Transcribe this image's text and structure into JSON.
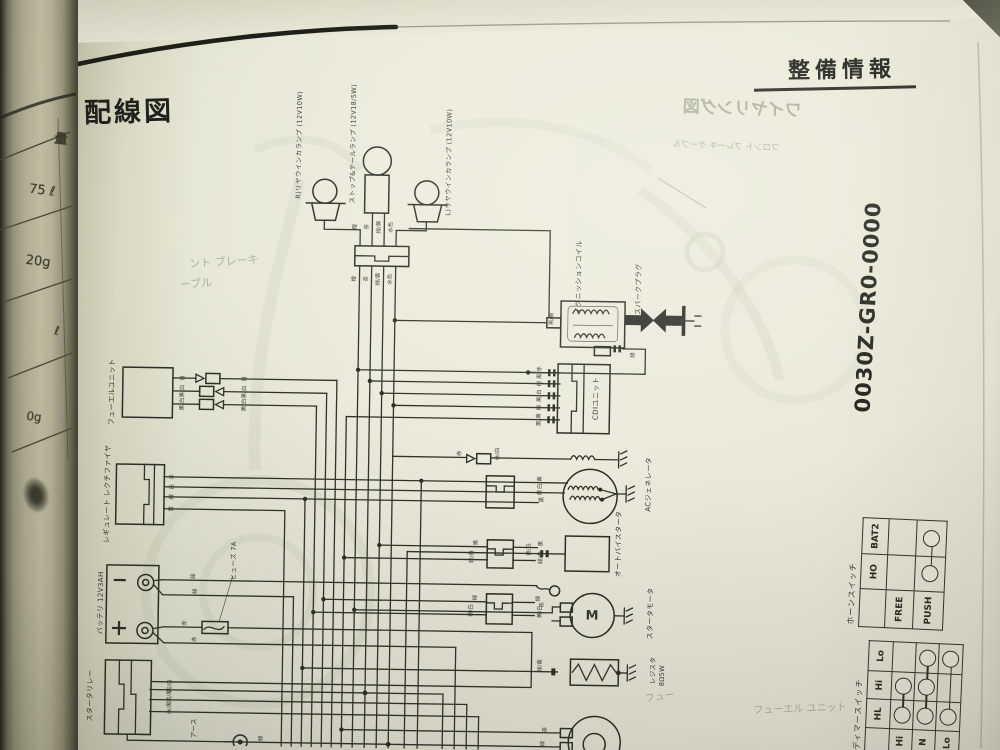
{
  "page": {
    "section_title": "整備情報",
    "title": "配線図",
    "part_number": "0030Z-GR0-0000"
  },
  "horn_switch": {
    "title": "ホーンスイッチ",
    "col_headers": [
      "HO",
      "BAT2"
    ],
    "rows": [
      {
        "label": "FREE",
        "connected": []
      },
      {
        "label": "PUSH",
        "connected": [
          "HO",
          "BAT2"
        ]
      }
    ]
  },
  "dimmer_switch": {
    "title": "ディマースイッチ",
    "col_headers": [
      "HL",
      "Hi",
      "Lo"
    ],
    "rows": [
      {
        "label": "Hi",
        "connected": [
          "HL",
          "Hi"
        ]
      },
      {
        "label": "N",
        "connected": [
          "HL",
          "Hi",
          "Lo"
        ]
      },
      {
        "label": "Lo",
        "connected": [
          "HL",
          "Lo"
        ]
      }
    ]
  },
  "render": {
    "labels": [
      {
        "k": "comp",
        "t": "R)リヤウインカランプ (12V10W)",
        "x": 296,
        "y": 148,
        "fs": 6.5,
        "r": -90
      },
      {
        "k": "comp",
        "t": "ストップ&テールランプ (12V18/5W)",
        "x": 350,
        "y": 146,
        "fs": 6.5,
        "r": -90
      },
      {
        "k": "comp",
        "t": "L)リヤウインカランプ (12V10W)",
        "x": 446,
        "y": 163,
        "fs": 6.5,
        "r": -90
      },
      {
        "k": "comp",
        "t": "イグニッションコイル",
        "x": 578,
        "y": 276,
        "fs": 7,
        "r": -90
      },
      {
        "k": "comp",
        "t": "スパークプラグ",
        "x": 638,
        "y": 287,
        "fs": 7,
        "r": -90
      },
      {
        "k": "comp",
        "t": "CDIユニット",
        "x": 597,
        "y": 397,
        "fs": 7,
        "r": -90
      },
      {
        "k": "comp",
        "t": "ACジェネレータ",
        "x": 651,
        "y": 482,
        "fs": 7,
        "r": -90
      },
      {
        "k": "comp",
        "t": "オートバイスタータ",
        "x": 622,
        "y": 542,
        "fs": 7,
        "r": -90
      },
      {
        "k": "comp",
        "t": "スタータモータ",
        "x": 655,
        "y": 611,
        "fs": 7,
        "r": -90
      },
      {
        "k": "comp",
        "t": "レジスタ",
        "x": 658,
        "y": 668,
        "fs": 6.5,
        "r": -90
      },
      {
        "k": "comp",
        "t": "8Ω5W",
        "x": 667,
        "y": 673,
        "fs": 6.5,
        "r": -90
      },
      {
        "k": "comp",
        "t": "フューエルユニット",
        "x": 113,
        "y": 398,
        "fs": 7,
        "r": -90
      },
      {
        "k": "comp",
        "t": "レギュレート レクチファイヤ",
        "x": 110,
        "y": 500,
        "fs": 7,
        "r": -90
      },
      {
        "k": "comp",
        "t": "ヒューズ 7A",
        "x": 237,
        "y": 565,
        "fs": 6.5,
        "r": -90
      },
      {
        "k": "comp",
        "t": "バッテリ 12V3AH",
        "x": 105,
        "y": 609,
        "fs": 7,
        "r": -90
      },
      {
        "k": "comp",
        "t": "スタータリレー",
        "x": 96,
        "y": 702,
        "fs": 7,
        "r": -90
      },
      {
        "k": "comp",
        "t": "アース",
        "x": 200,
        "y": 733,
        "fs": 6.5,
        "r": -90
      },
      {
        "k": "comp",
        "t": "M",
        "x": 596,
        "y": 615,
        "fs": 13,
        "r": 0,
        "b": 1
      },
      {
        "k": "wire",
        "t": "橙",
        "x": 354,
        "y": 229,
        "fs": 5.5,
        "r": -90
      },
      {
        "k": "wire",
        "t": "茶",
        "x": 366,
        "y": 229,
        "fs": 5.5,
        "r": -90
      },
      {
        "k": "wire",
        "t": "緑/黄",
        "x": 378,
        "y": 229,
        "fs": 5.5,
        "r": -90
      },
      {
        "k": "wire",
        "t": "水色",
        "x": 390,
        "y": 229,
        "fs": 5.5,
        "r": -90
      },
      {
        "k": "wire",
        "t": "橙",
        "x": 354,
        "y": 281,
        "fs": 5.5,
        "r": -90
      },
      {
        "k": "wire",
        "t": "茶",
        "x": 366,
        "y": 281,
        "fs": 5.5,
        "r": -90
      },
      {
        "k": "wire",
        "t": "緑/黄",
        "x": 378,
        "y": 281,
        "fs": 5.5,
        "r": -90
      },
      {
        "k": "wire",
        "t": "水色",
        "x": 390,
        "y": 281,
        "fs": 5.5,
        "r": -90
      },
      {
        "k": "wire",
        "t": "青",
        "x": 184,
        "y": 383,
        "fs": 5.5,
        "r": -90
      },
      {
        "k": "wire",
        "t": "青",
        "x": 246,
        "y": 383,
        "fs": 5.5,
        "r": -90
      },
      {
        "k": "wire",
        "t": "黒/白",
        "x": 184,
        "y": 396,
        "fs": 5.5,
        "r": -90
      },
      {
        "k": "wire",
        "t": "黒/白",
        "x": 246,
        "y": 396,
        "fs": 5.5,
        "r": -90
      },
      {
        "k": "wire",
        "t": "黒/白",
        "x": 184,
        "y": 409,
        "fs": 5.5,
        "r": -90
      },
      {
        "k": "wire",
        "t": "黒/白",
        "x": 246,
        "y": 409,
        "fs": 5.5,
        "r": -90
      },
      {
        "k": "wire",
        "t": "赤",
        "x": 175,
        "y": 482,
        "fs": 5.5,
        "r": -90
      },
      {
        "k": "wire",
        "t": "白",
        "x": 175,
        "y": 492,
        "fs": 5.5,
        "r": -90
      },
      {
        "k": "wire",
        "t": "緑",
        "x": 175,
        "y": 502,
        "fs": 5.5,
        "r": -90
      },
      {
        "k": "wire",
        "t": "黄",
        "x": 175,
        "y": 514,
        "fs": 5.5,
        "r": -90
      },
      {
        "k": "wire",
        "t": "緑",
        "x": 198,
        "y": 581,
        "fs": 5.5,
        "r": -90
      },
      {
        "k": "wire",
        "t": "緑",
        "x": 200,
        "y": 596,
        "fs": 5.5,
        "r": -90
      },
      {
        "k": "wire",
        "t": "赤",
        "x": 190,
        "y": 628,
        "fs": 5.5,
        "r": -90
      },
      {
        "k": "wire",
        "t": "赤",
        "x": 200,
        "y": 644,
        "fs": 5.5,
        "r": -90
      },
      {
        "k": "wire",
        "t": "黒/白",
        "x": 176,
        "y": 691,
        "fs": 5.5,
        "r": -90
      },
      {
        "k": "wire",
        "t": "黄/黒",
        "x": 176,
        "y": 701,
        "fs": 5.5,
        "r": -90
      },
      {
        "k": "wire",
        "t": "赤/黒",
        "x": 176,
        "y": 713,
        "fs": 5.5,
        "r": -90
      },
      {
        "k": "wire",
        "t": "緑",
        "x": 268,
        "y": 742,
        "fs": 5.5,
        "r": -90
      },
      {
        "k": "wire",
        "t": "黒/赤",
        "x": 541,
        "y": 372,
        "fs": 5.5,
        "r": -90
      },
      {
        "k": "wire",
        "t": "橙",
        "x": 541,
        "y": 383,
        "fs": 5.5,
        "r": -90
      },
      {
        "k": "wire",
        "t": "黒/白",
        "x": 541,
        "y": 395,
        "fs": 5.5,
        "r": -90
      },
      {
        "k": "wire",
        "t": "緑",
        "x": 541,
        "y": 407,
        "fs": 5.5,
        "r": -90
      },
      {
        "k": "wire",
        "t": "黒/黄",
        "x": 541,
        "y": 419,
        "fs": 5.5,
        "r": -90
      },
      {
        "k": "wire",
        "t": "黒/黄",
        "x": 552,
        "y": 318,
        "fs": 5.5,
        "r": -90
      },
      {
        "k": "wire",
        "t": "緑",
        "x": 634,
        "y": 353,
        "fs": 5.5,
        "r": -90
      },
      {
        "k": "wire",
        "t": "白/黄",
        "x": 543,
        "y": 482,
        "fs": 5.5,
        "r": -90
      },
      {
        "k": "wire",
        "t": "黄",
        "x": 543,
        "y": 492,
        "fs": 5.5,
        "r": -90
      },
      {
        "k": "wire",
        "t": "黄/白",
        "x": 533,
        "y": 549,
        "fs": 5.5,
        "r": -90
      },
      {
        "k": "wire",
        "t": "赤",
        "x": 547,
        "y": 604,
        "fs": 5.5,
        "r": -90
      },
      {
        "k": "wire",
        "t": "緑/黄",
        "x": 546,
        "y": 665,
        "fs": 5.5,
        "r": -90
      },
      {
        "k": "wire",
        "t": "茶",
        "x": 552,
        "y": 729,
        "fs": 5.5,
        "r": -90
      },
      {
        "k": "wire",
        "t": "緑",
        "x": 550,
        "y": 743,
        "fs": 5.5,
        "r": -90
      },
      {
        "k": "wire",
        "t": "赤",
        "x": 462,
        "y": 454,
        "fs": 5.5,
        "r": -90
      },
      {
        "k": "wire",
        "t": "赤/白",
        "x": 500,
        "y": 454,
        "fs": 5.5,
        "r": -90
      },
      {
        "k": "wire",
        "t": "黒",
        "x": 545,
        "y": 499,
        "fs": 5.5,
        "r": -90
      },
      {
        "k": "wire",
        "t": "黒",
        "x": 480,
        "y": 543,
        "fs": 5.5,
        "r": -90
      },
      {
        "k": "wire",
        "t": "黒",
        "x": 545,
        "y": 543,
        "fs": 5.5,
        "r": -90
      },
      {
        "k": "wire",
        "t": "緑/黄",
        "x": 476,
        "y": 557,
        "fs": 5.5,
        "r": -90
      },
      {
        "k": "wire",
        "t": "緑/黄",
        "x": 545,
        "y": 557,
        "fs": 5.5,
        "r": -90
      },
      {
        "k": "wire",
        "t": "緑",
        "x": 480,
        "y": 598,
        "fs": 5.5,
        "r": -90
      },
      {
        "k": "wire",
        "t": "緑",
        "x": 543,
        "y": 598,
        "fs": 5.5,
        "r": -90
      },
      {
        "k": "wire",
        "t": "黄/白",
        "x": 476,
        "y": 611,
        "fs": 5.5,
        "r": -90
      },
      {
        "k": "wire",
        "t": "黄/白",
        "x": 545,
        "y": 611,
        "fs": 5.5,
        "r": -90
      },
      {
        "k": "strip",
        "t": "量",
        "x": 61,
        "y": 140,
        "fs": 13,
        "r": 7,
        "b": 1
      },
      {
        "k": "strip",
        "t": "75 ℓ",
        "x": 42,
        "y": 191,
        "fs": 13,
        "r": 7
      },
      {
        "k": "strip",
        "t": "20g",
        "x": 38,
        "y": 262,
        "fs": 13,
        "r": 7
      },
      {
        "k": "strip",
        "t": "ℓ",
        "x": 57,
        "y": 331,
        "fs": 12,
        "r": 7
      },
      {
        "k": "strip",
        "t": "0g",
        "x": 34,
        "y": 417,
        "fs": 12,
        "r": 7
      },
      {
        "k": "ghost",
        "t": "ワイヤリング図",
        "x": 742,
        "y": 110,
        "fs": 17,
        "r": 2,
        "b": 1,
        "mx": 1
      },
      {
        "k": "ghost",
        "t": "フロント ブレーキ ケーブル",
        "x": 726,
        "y": 147,
        "fs": 8.5,
        "r": 2,
        "mx": 1
      },
      {
        "k": "ghost",
        "t": "ント ブレーキ",
        "x": 224,
        "y": 262,
        "fs": 11,
        "r": -4
      },
      {
        "k": "ghost",
        "t": "ーブル",
        "x": 196,
        "y": 284,
        "fs": 11,
        "r": -4
      },
      {
        "k": "ghost",
        "t": "フューエル ユニット",
        "x": 800,
        "y": 710,
        "fs": 10,
        "r": -2
      },
      {
        "k": "ghost",
        "t": "フュー",
        "x": 660,
        "y": 698,
        "fs": 10,
        "r": -8
      }
    ]
  }
}
